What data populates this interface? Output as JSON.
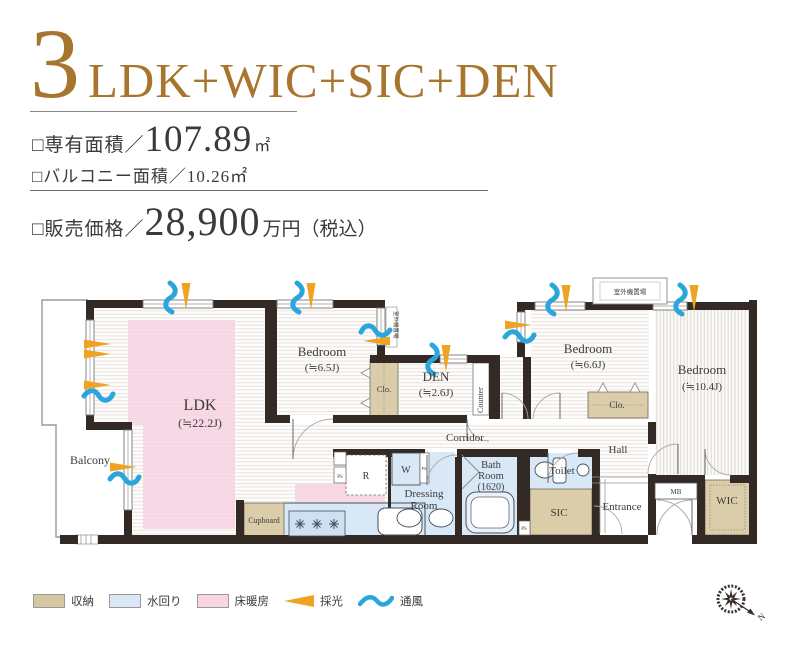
{
  "header": {
    "number": "3",
    "type_suffix": "LDK+WIC+SIC+DEN"
  },
  "specs": {
    "area_label": "□専有面積／",
    "area_value": "107.89",
    "area_unit": "㎡",
    "balcony_line": "□バルコニー面積／10.26㎡",
    "price_label": "□販売価格／",
    "price_value": "28,900",
    "price_suffix": "万円（税込）"
  },
  "plan": {
    "rooms": {
      "balcony": "Balcony",
      "ldk_name": "LDK",
      "ldk_size": "(≒22.2J)",
      "bedroom1_name": "Bedroom",
      "bedroom1_size": "(≒6.5J)",
      "den_name": "DEN",
      "den_size": "(≒2.6J)",
      "bedroom2_name": "Bedroom",
      "bedroom2_size": "(≒6.6J)",
      "bedroom3_name": "Bedroom",
      "bedroom3_size": "(≒10.4J)",
      "corridor": "Corridor",
      "hall": "Hall",
      "entrance": "Entrance",
      "dressing_line1": "Dressing",
      "dressing_line2": "Room",
      "bath_line1": "Bath",
      "bath_line2": "Room",
      "bath_line3": "(1620)",
      "toilet": "Toilet",
      "sic": "SIC",
      "wic": "WIC",
      "mb": "MB",
      "closet": "Clo.",
      "counter": "Counter",
      "cupboard": "Cupboard",
      "fridge": "R",
      "washer": "W",
      "ps": "PS",
      "outdoor_unit": "室外機置場"
    },
    "compass_north": "N"
  },
  "legend": {
    "items": [
      {
        "label": "収納",
        "swatch": "beige"
      },
      {
        "label": "水回り",
        "swatch": "lightblue"
      },
      {
        "label": "床暖房",
        "swatch": "pink"
      },
      {
        "label": "採光",
        "swatch": "orange-triangle"
      },
      {
        "label": "通風",
        "swatch": "blue-wave"
      }
    ]
  },
  "colors": {
    "accent_bronze": "#a8752e",
    "storage_beige": "#dbcda9",
    "water_blue": "#d9e8f6",
    "floor_heating_pink": "#f7d2e2",
    "daylight_orange": "#f0a322",
    "airflow_blue": "#2aa6dc",
    "wall": "#332a26"
  }
}
